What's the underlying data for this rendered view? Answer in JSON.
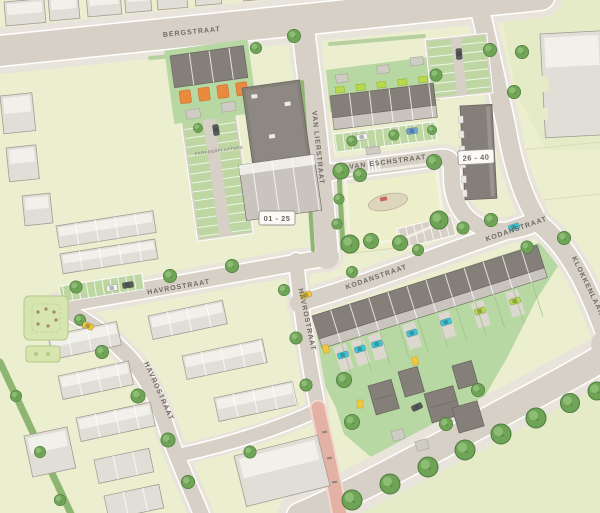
{
  "map": {
    "type": "residential-site-plan",
    "streets": {
      "bergstraat": "BERGSTRAAT",
      "van_lierstraat": "VAN LIERSTRAAT",
      "van_eschstraat": "VAN ESCHSTRAAT",
      "kodanstraat_west": "KODANSTRAAT",
      "kodanstraat_east": "KODANSTRAAT",
      "havrostraat_north": "HAVROSTRAAT",
      "havrostraat_south": "HAVROSTRAAT",
      "havrostraat_west": "HAVROSTRAAT",
      "klokkenlaan": "KLOKKENLAAN"
    },
    "buildings": {
      "block_a": "01 - 25",
      "block_b": "26 - 40"
    },
    "annotations": {
      "parking": "PARKEERPLAATSEN"
    },
    "colors": {
      "lawn": "#ebeecf",
      "lawn_alt": "#e5ebc6",
      "garden": "#b7d8a3",
      "park": "#ecefc9",
      "road": "#d7d0c7",
      "sidewalk": "#e8e4db",
      "bld_light": "#e1ded7",
      "bld_light_roof": "#f2f0ea",
      "bld_stroke": "#a19c94",
      "bld_dark_roof": "#847f78",
      "bld_dark_face": "#c9c5be",
      "tree": "#6fa457",
      "tree_dark": "#4e7b3d",
      "hedge": "#8fb573",
      "stripe_green": "#bdd6a2",
      "car_cyan": "#3fc5d4",
      "car_yellow": "#f1c73b",
      "car_blue": "#6fa0cf",
      "car_white": "#f5f5f3",
      "car_dark": "#5a5a58",
      "accent_orange": "#ea8a3e",
      "accent_lime": "#b9d84b",
      "path_pink": "#e3b2a5",
      "label": "#6f6a63"
    }
  }
}
